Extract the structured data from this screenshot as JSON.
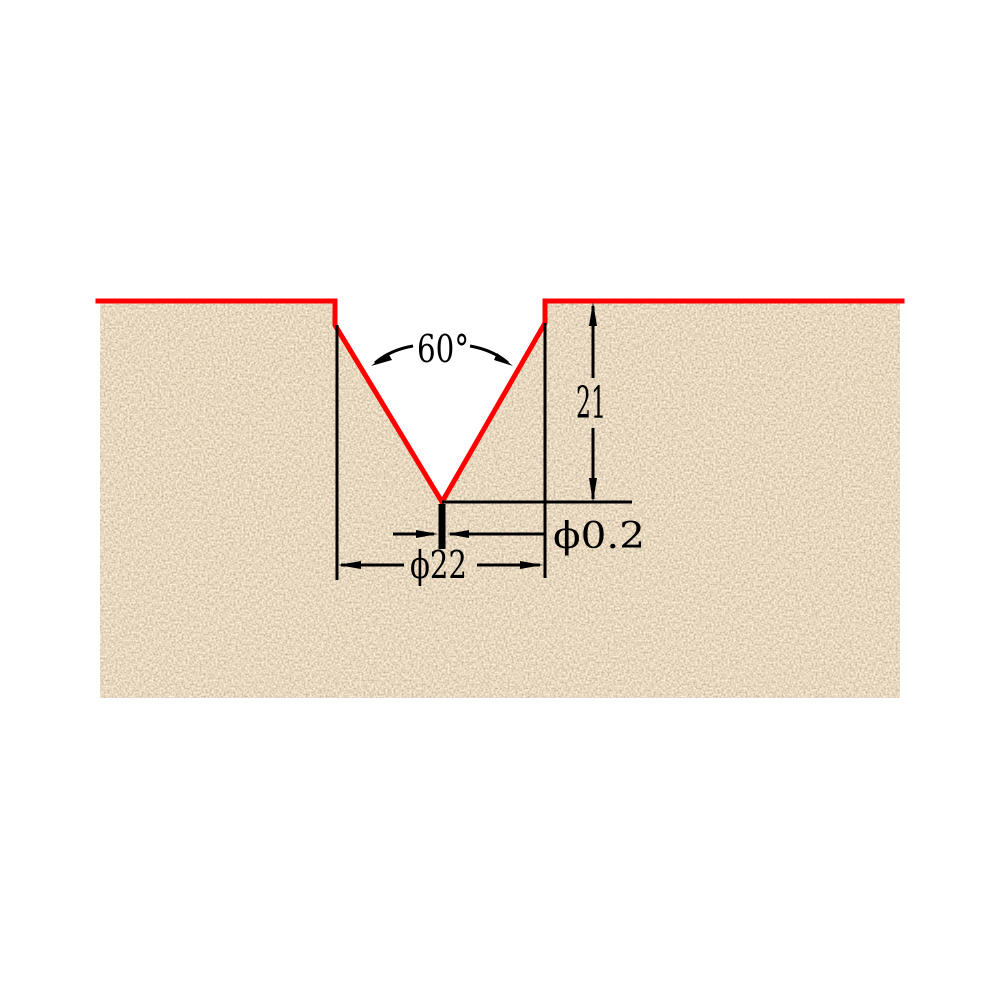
{
  "diagram": {
    "kind": "v-groove-cross-section-dimension-drawing",
    "annotations": {
      "groove_angle": "60°",
      "groove_depth": "21",
      "tip_diameter": "ϕ0.2",
      "groove_top_width": "ϕ22"
    },
    "colors": {
      "profile_outline": "#ff0000",
      "dimension_lines": "#000000",
      "material_base": "#cdbc9e",
      "background": "#ffffff"
    }
  }
}
